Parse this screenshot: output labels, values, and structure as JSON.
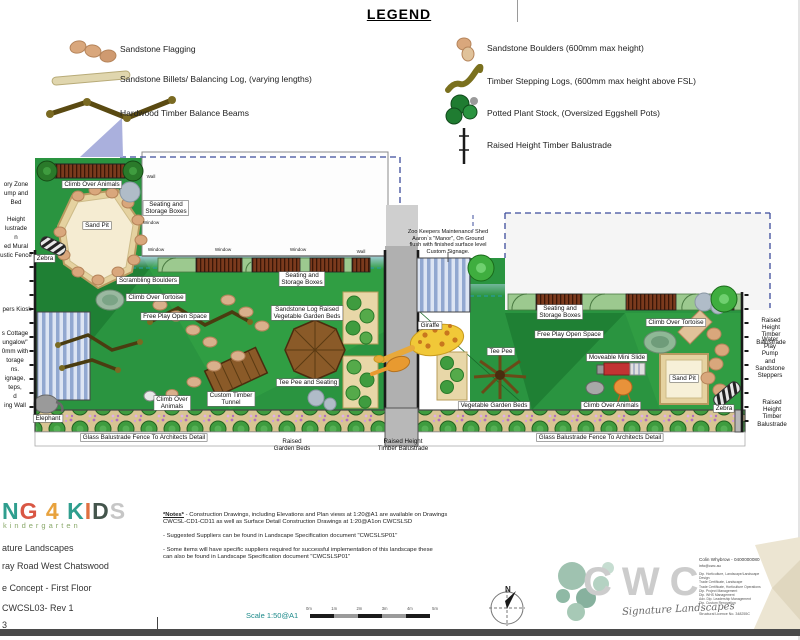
{
  "legend": {
    "title": "LEGEND",
    "left_items": [
      {
        "icon": "sandstone-flagging-icon",
        "label": "Sandstone Flagging"
      },
      {
        "icon": "sandstone-billets-icon",
        "label": "Sandstone Billets/ Balancing Log, (varying lengths)"
      },
      {
        "icon": "hardwood-balance-beams-icon",
        "label": "Hardwood Timber Balance Beams"
      }
    ],
    "right_items": [
      {
        "icon": "sandstone-boulders-icon",
        "label": "Sandstone Boulders (600mm max height)"
      },
      {
        "icon": "timber-stepping-logs-icon",
        "label": "Timber Stepping Logs, (600mm max height above FSL)"
      },
      {
        "icon": "potted-plant-stock-icon",
        "label": "Potted Plant Stock, (Oversized Eggshell Pots)"
      },
      {
        "icon": "raised-balustrade-icon",
        "label": "Raised Height Timber Balustrade"
      }
    ]
  },
  "plan": {
    "labels": [
      {
        "t": "Climb Over Animals",
        "x": 92,
        "y": 181,
        "s": "box"
      },
      {
        "t": "Sand Pit",
        "x": 97,
        "y": 222,
        "s": "box"
      },
      {
        "t": "Zebra",
        "x": 45,
        "y": 255,
        "s": "box"
      },
      {
        "t": "Scrambling Boulders",
        "x": 148,
        "y": 277,
        "s": "box"
      },
      {
        "t": "Climb Over Tortoise",
        "x": 156,
        "y": 294,
        "s": "box"
      },
      {
        "t": "Free Play Open Space",
        "x": 175,
        "y": 313,
        "s": "box"
      },
      {
        "t": "Sandstone Log Raised\nVegetable Garden Beds",
        "x": 307,
        "y": 306,
        "s": "box"
      },
      {
        "t": "Tee Pee and Seating",
        "x": 308,
        "y": 379,
        "s": "box"
      },
      {
        "t": "Custom Timber\nTunnel",
        "x": 231,
        "y": 392,
        "s": "box"
      },
      {
        "t": "Climb Over\nAnimals",
        "x": 172,
        "y": 396,
        "s": "box"
      },
      {
        "t": "Elephant",
        "x": 48,
        "y": 415,
        "s": "box"
      },
      {
        "t": "Glass Balustrade Fence To Architects Detail",
        "x": 144,
        "y": 434,
        "s": "box"
      },
      {
        "t": "Seating and\nStorage Boxes",
        "x": 166,
        "y": 201,
        "s": "box"
      },
      {
        "t": "Seating and\nStorage Boxes",
        "x": 302,
        "y": 272,
        "s": "box"
      },
      {
        "t": "Giraffe",
        "x": 430,
        "y": 322,
        "s": "box"
      },
      {
        "t": "Seating and\nStorage Boxes",
        "x": 560,
        "y": 305,
        "s": "box"
      },
      {
        "t": "Free Play Open Space",
        "x": 569,
        "y": 331,
        "s": "box"
      },
      {
        "t": "Tee Pee",
        "x": 501,
        "y": 348,
        "s": "box"
      },
      {
        "t": "Moveable Mini Slide",
        "x": 617,
        "y": 354,
        "s": "box"
      },
      {
        "t": "Vegetable Garden Beds",
        "x": 494,
        "y": 402,
        "s": "box"
      },
      {
        "t": "Climb Over Animals",
        "x": 611,
        "y": 402,
        "s": "box"
      },
      {
        "t": "Climb Over Tortoise",
        "x": 676,
        "y": 319,
        "s": "box"
      },
      {
        "t": "Sand Pit",
        "x": 684,
        "y": 375,
        "s": "box"
      },
      {
        "t": "Zebra",
        "x": 724,
        "y": 405,
        "s": "box"
      },
      {
        "t": "Glass Balustrade Fence To Architects Detail",
        "x": 600,
        "y": 434,
        "s": "box"
      },
      {
        "t": "Wall",
        "x": 151,
        "y": 174,
        "s": "tiny"
      },
      {
        "t": "Window",
        "x": 151,
        "y": 220,
        "s": "tiny"
      },
      {
        "t": "Window",
        "x": 156,
        "y": 247,
        "s": "tiny"
      },
      {
        "t": "Window",
        "x": 223,
        "y": 247,
        "s": "tiny"
      },
      {
        "t": "Window",
        "x": 298,
        "y": 247,
        "s": "tiny"
      },
      {
        "t": "Wall",
        "x": 361,
        "y": 249,
        "s": "tiny"
      },
      {
        "t": "Zoo Keepers Maintenance Shed\nAaron`s \"Manor\", On Ground\nflush with finished surface level\nCustom Signage.",
        "x": 448,
        "y": 229,
        "s": "ann"
      },
      {
        "t": "Raised\nGarden Beds",
        "x": 292,
        "y": 438,
        "s": "plain"
      },
      {
        "t": "Raised Height\nTimber Balustrade",
        "x": 403,
        "y": 438,
        "s": "plain"
      },
      {
        "t": "Raised Height\nTimber Balustrade",
        "x": 771,
        "y": 317,
        "s": "plain"
      },
      {
        "t": "Water Play Pump\nand\nSandstone\nSteppers",
        "x": 770,
        "y": 336,
        "s": "plain"
      },
      {
        "t": "Raised Height\nTimber Balustrade",
        "x": 772,
        "y": 399,
        "s": "plain"
      },
      {
        "t": "ory Zone\nump and\nBed",
        "x": 16,
        "y": 180,
        "s": "frag"
      },
      {
        "t": "Height\nlustrade\nn\ned Mural\nustic Fence",
        "x": 16,
        "y": 215,
        "s": "frag"
      },
      {
        "t": "pers Kiosk",
        "x": 17,
        "y": 305,
        "s": "frag"
      },
      {
        "t": "s Cottage\nungalow\"\n0mm with\ntorage\nns.\nignage,\nteps,\nd\ning Wall",
        "x": 15,
        "y": 329,
        "s": "frag"
      }
    ]
  },
  "compass": {
    "n": "N"
  },
  "scale": {
    "label": "Scale 1:50@A1",
    "ticks": [
      "0m",
      "1m",
      "2m",
      "3m",
      "4m",
      "5m"
    ]
  },
  "title_block": {
    "logo_letters": [
      {
        "ch": "N",
        "color": "#2f9e8e"
      },
      {
        "ch": "G",
        "color": "#d95744"
      },
      {
        "ch": " 4 ",
        "color": "#e8a23d"
      },
      {
        "ch": "K",
        "color": "#2f9e8e"
      },
      {
        "ch": "I",
        "color": "#e07040"
      },
      {
        "ch": "D",
        "color": "#44554c"
      },
      {
        "ch": "S",
        "color": "#c6c6c6"
      }
    ],
    "logo_sub": "kindergarten",
    "rows": [
      "ature Landscapes",
      "ray Road West Chatswood",
      "e Concept - First Floor",
      "CWCSL03- Rev 1",
      "3"
    ]
  },
  "notes": {
    "heading": "*Notes*",
    "body": "- Construction Drawings, including Elevations and Plan views at 1:20@A1 are available on Drawings\nCWCSL-CD1-CD11 as well as Surface Detail Construction Drawings at 1:20@A1on CWCSLSD\n\n- Suggested Suppliers can be found in Landscape Specification document \"CWCSLSP01\"\n\n- Some items will have specific suppliers required for successful implementation of this landscape these\ncan also be found in Landscape Specification document \"CWCSLSP01\""
  },
  "firm": {
    "logo": "CWC",
    "tagline": "Signature Landscapes",
    "contact_name": "Colin Whybrow - 0400000080",
    "email": "info@cwc.au",
    "credentials": [
      "Dip. Horticulture, Landscape/Landscape Design",
      "Trade Certificate, Landscape",
      "Trade Certificate, Horticulture Operations",
      "Dip. Project Management",
      "Dip. WHS Management",
      "Adv. Dip. Leadership Management",
      "Dip. Custom Renovation"
    ],
    "licence": "Structural Licence No. 348255C"
  },
  "colors": {
    "grass": "#2a9440",
    "grass_dark": "#1f8034",
    "grass_bright": "#35a546",
    "sand": "#f5ecd2",
    "sand_border": "#b89a60",
    "planter_strip": "#d8c493",
    "roof_blue": "#92a8d0",
    "box_brown": "#7b3a1d",
    "dashed_boundary": "#3c4c9c",
    "teal_dash": "#2a9a9a",
    "scale_text": "#1d8a8a",
    "footer_bar": "#4a4a4a"
  }
}
